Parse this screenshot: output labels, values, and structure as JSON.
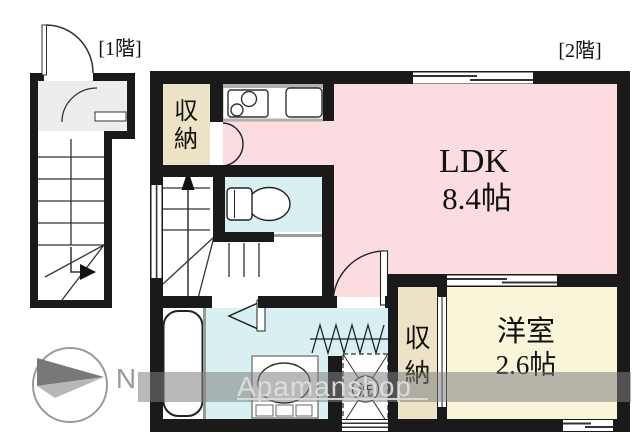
{
  "floor_plan": {
    "floor_labels": {
      "first": "[1階]",
      "second": "[2階]"
    },
    "rooms": {
      "ldk": {
        "name": "LDK",
        "size": "8.4帖",
        "color": "#fbdce1"
      },
      "western_room": {
        "name": "洋室",
        "size": "2.6帖",
        "color": "#f8f5d8"
      },
      "closet_upper": {
        "name": "収納",
        "chars": [
          "収",
          "納"
        ],
        "color": "#ece2c5"
      },
      "closet_lower": {
        "name": "収納",
        "chars": [
          "収",
          "納"
        ],
        "color": "#ece2c5"
      }
    },
    "wet_area_color": "#d8f0f2",
    "wall_color": "#1a1a1a",
    "symbols": {
      "laundry": "洗"
    },
    "compass": {
      "label": "N"
    },
    "watermark": {
      "text": "Apamanshop"
    }
  }
}
